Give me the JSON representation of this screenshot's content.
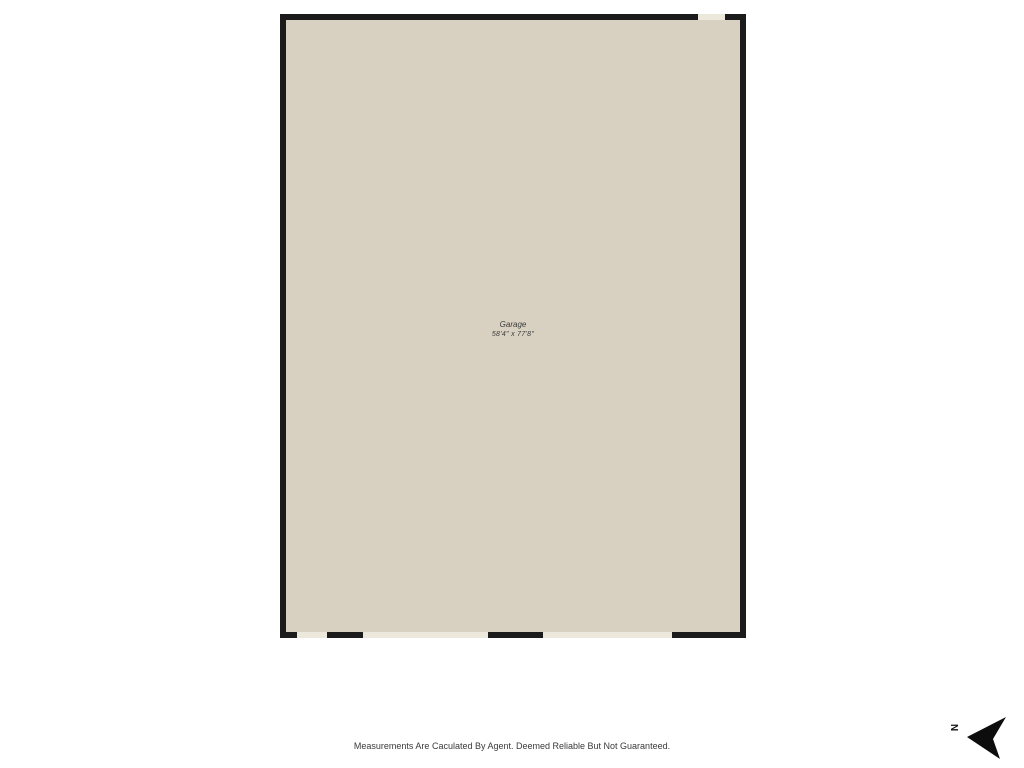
{
  "plan": {
    "room": {
      "label": "Garage",
      "dimensions": "58'4\" x 77'8\""
    },
    "colors": {
      "floor": "#d8d1c1",
      "wall": "#1b1b1b",
      "opening": "#ece8db"
    },
    "openings": [
      {
        "side": "top",
        "left": 418,
        "width": 27
      },
      {
        "side": "bottom",
        "left": 17,
        "width": 30
      },
      {
        "side": "bottom",
        "left": 83,
        "width": 125
      },
      {
        "side": "bottom",
        "left": 263,
        "width": 129
      }
    ]
  },
  "compass": {
    "label": "N"
  },
  "footer": {
    "disclaimer": "Measurements Are Caculated By Agent. Deemed Reliable But Not Guaranteed."
  }
}
